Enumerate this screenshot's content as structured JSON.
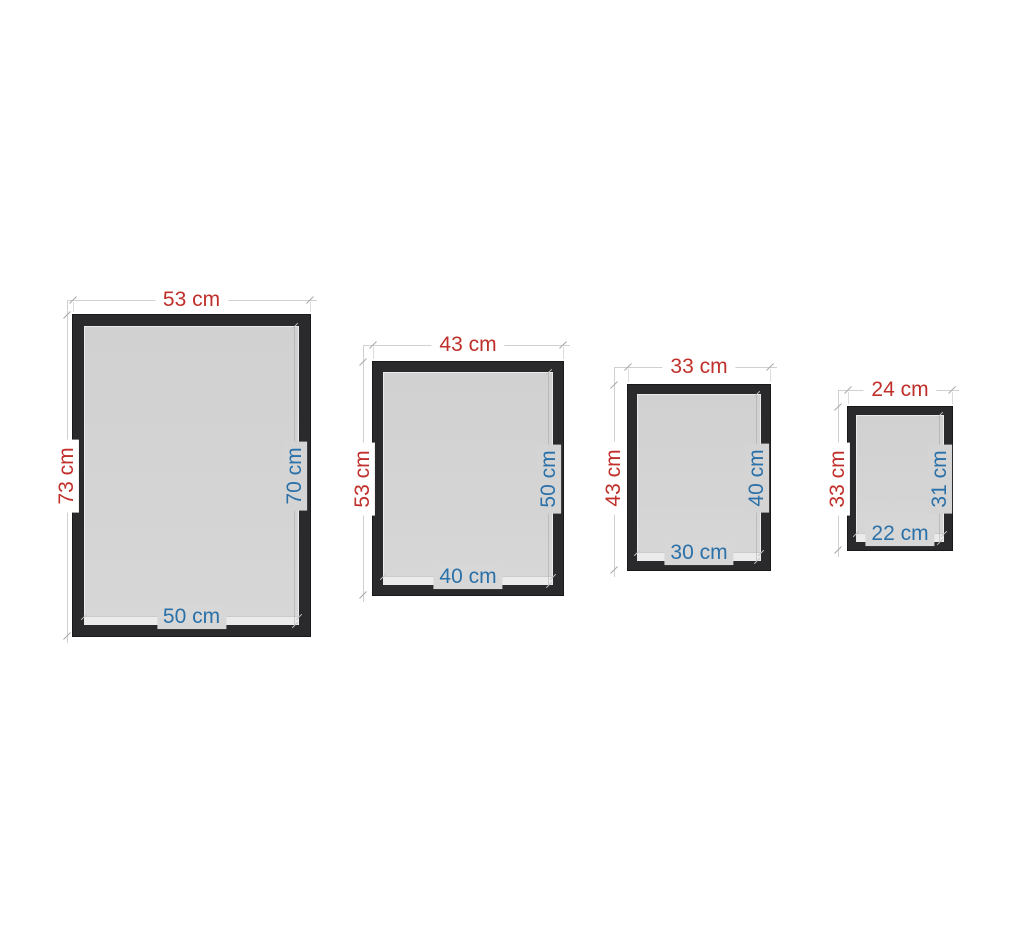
{
  "scene": {
    "background": "#ffffff",
    "description": "Four black picture frames of decreasing size with outer dimensions annotated in red and inner (visible/glass) dimensions annotated in blue"
  },
  "colors": {
    "outer_dimension": "#c0302b",
    "inner_dimension": "#2b71a9",
    "frame": "#2a2a2c",
    "glass": "#d4d4d4",
    "dimension_line": "#d0d0d0"
  },
  "frames": [
    {
      "outer_width": "53 cm",
      "outer_height": "73 cm",
      "inner_height": "70 cm",
      "inner_width": "50 cm"
    },
    {
      "outer_width": "43 cm",
      "outer_height": "53 cm",
      "inner_height": "50 cm",
      "inner_width": "40 cm"
    },
    {
      "outer_width": "33 cm",
      "outer_height": "43 cm",
      "inner_height": "40 cm",
      "inner_width": "30 cm"
    },
    {
      "outer_width": "24 cm",
      "outer_height": "33 cm",
      "inner_height": "31 cm",
      "inner_width": "22 cm"
    }
  ]
}
